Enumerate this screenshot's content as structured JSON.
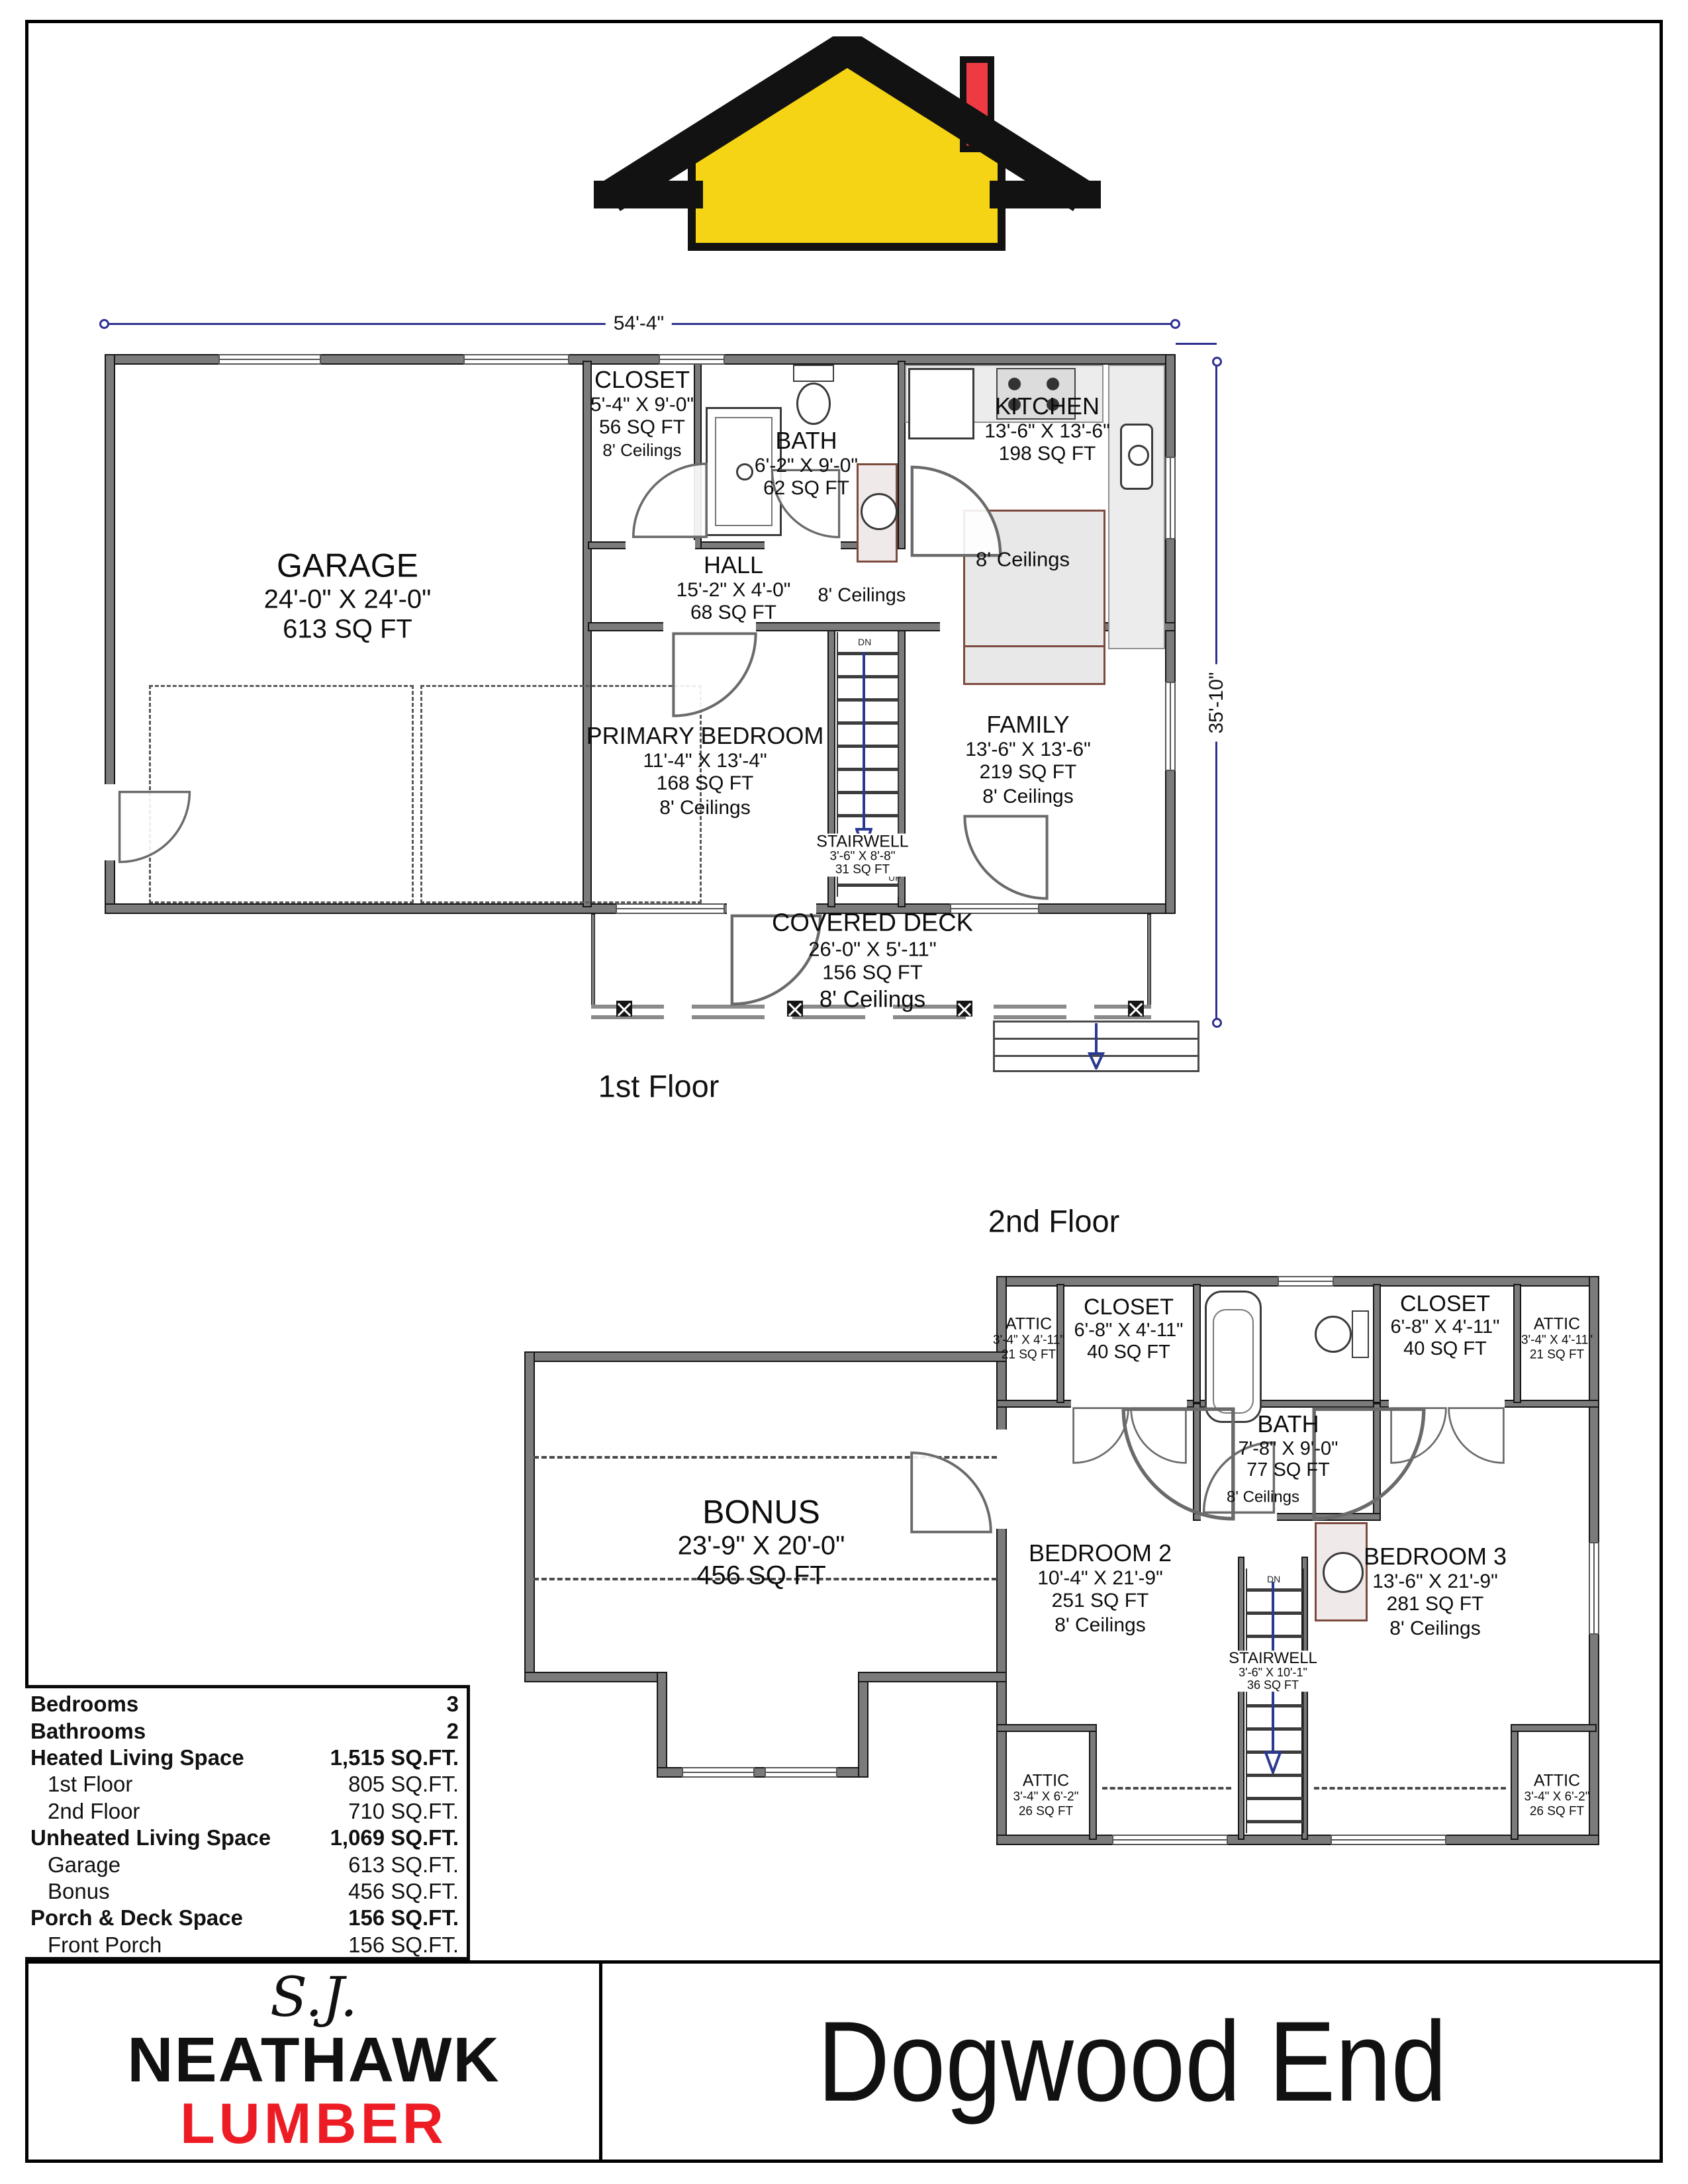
{
  "logo": {
    "body_color": "#f4d414",
    "roof_color": "#121212",
    "chimney_color": "#ee3a43"
  },
  "floor1": {
    "label": "1st Floor",
    "width_dim": "54'-4\"",
    "height_dim": "35'-10\"",
    "rooms": {
      "garage": {
        "name": "GARAGE",
        "dims": "24'-0\" X 24'-0\"",
        "area": "613 SQ FT"
      },
      "closet": {
        "name": "CLOSET",
        "dims": "5'-4\" X 9'-0\"",
        "area": "56 SQ FT",
        "ceilings": "8' Ceilings"
      },
      "bath": {
        "name": "BATH",
        "dims": "6'-2\" X 9'-0\"",
        "area": "62 SQ FT"
      },
      "kitchen": {
        "name": "KITCHEN",
        "dims": "13'-6\" X 13'-6\"",
        "area": "198 SQ FT",
        "ceilings": "8' Ceilings"
      },
      "hall": {
        "name": "HALL",
        "dims": "15'-2\" X 4'-0\"",
        "area": "68 SQ FT",
        "ceilings": "8' Ceilings"
      },
      "primary": {
        "name": "PRIMARY BEDROOM",
        "dims": "11'-4\" X 13'-4\"",
        "area": "168 SQ FT",
        "ceilings": "8' Ceilings"
      },
      "family": {
        "name": "FAMILY",
        "dims": "13'-6\" X 13'-6\"",
        "area": "219 SQ FT",
        "ceilings": "8' Ceilings"
      },
      "stairwell": {
        "name": "STAIRWELL",
        "dims": "3'-6\" X 8'-8\"",
        "area": "31 SQ FT",
        "up": "UP",
        "dn": "DN"
      },
      "deck": {
        "name": "COVERED DECK",
        "dims": "26'-0\" X 5'-11\"",
        "area": "156 SQ FT",
        "ceilings": "8' Ceilings"
      }
    }
  },
  "floor2": {
    "label": "2nd Floor",
    "rooms": {
      "attic_tl": {
        "name": "ATTIC",
        "dims": "3'-4\" X 4'-11\"",
        "area": "21 SQ FT"
      },
      "closet_l": {
        "name": "CLOSET",
        "dims": "6'-8\" X 4'-11\"",
        "area": "40 SQ FT"
      },
      "bath": {
        "name": "BATH",
        "dims": "7'-8\" X 9'-0\"",
        "area": "77 SQ FT",
        "ceilings": "8' Ceilings"
      },
      "closet_r": {
        "name": "CLOSET",
        "dims": "6'-8\" X 4'-11\"",
        "area": "40 SQ FT"
      },
      "attic_tr": {
        "name": "ATTIC",
        "dims": "3'-4\" X 4'-11\"",
        "area": "21 SQ FT"
      },
      "bonus": {
        "name": "BONUS",
        "dims": "23'-9\" X 20'-0\"",
        "area": "456 SQ FT"
      },
      "bedroom2": {
        "name": "BEDROOM 2",
        "dims": "10'-4\" X 21'-9\"",
        "area": "251 SQ FT",
        "ceilings": "8' Ceilings"
      },
      "bedroom3": {
        "name": "BEDROOM 3",
        "dims": "13'-6\" X 21'-9\"",
        "area": "281 SQ FT",
        "ceilings": "8' Ceilings"
      },
      "stairwell": {
        "name": "STAIRWELL",
        "dims": "3'-6\" X 10'-1\"",
        "area": "36 SQ FT",
        "dn": "DN"
      },
      "attic_bl": {
        "name": "ATTIC",
        "dims": "3'-4\" X 6'-2\"",
        "area": "26 SQ FT"
      },
      "attic_br": {
        "name": "ATTIC",
        "dims": "3'-4\" X 6'-2\"",
        "area": "26 SQ FT"
      }
    }
  },
  "summary": {
    "rows": [
      {
        "label": "Bedrooms",
        "value": "3"
      },
      {
        "label": "Bathrooms",
        "value": "2"
      },
      {
        "label": "Heated Living Space",
        "value": "1,515 SQ.FT."
      },
      {
        "label": "1st Floor",
        "value": "805 SQ.FT."
      },
      {
        "label": "2nd Floor",
        "value": "710 SQ.FT."
      },
      {
        "label": "Unheated Living Space",
        "value": "1,069 SQ.FT."
      },
      {
        "label": "Garage",
        "value": "613 SQ.FT."
      },
      {
        "label": "Bonus",
        "value": "456 SQ.FT."
      },
      {
        "label": "Porch & Deck Space",
        "value": "156 SQ.FT."
      },
      {
        "label": "Front Porch",
        "value": "156 SQ.FT."
      }
    ]
  },
  "footer": {
    "brand_script": "S.J.",
    "brand_name": "NEATHAWK",
    "brand_sub": "LUMBER",
    "brand_sub_color": "#ed1c24",
    "title": "Dogwood End"
  }
}
